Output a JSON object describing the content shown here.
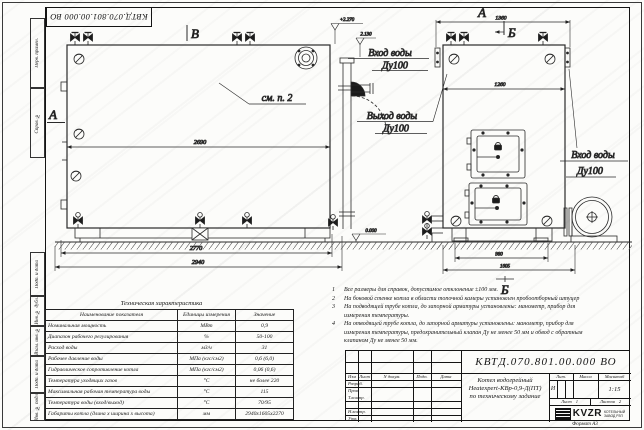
{
  "sheet": {
    "stamp_top_left": "КВТД.070.801.00.000 ВО",
    "format_label": "Формат  А3",
    "margin_labels": [
      "Перв. примен.",
      "Справ. №",
      "Подп. и дата",
      "Инв. № дубл.",
      "Взам. инв. №",
      "Подп. и дата",
      "Инв. № подл."
    ]
  },
  "views": {
    "front": {
      "view_label_top": "В",
      "view_label_side": "А",
      "see_note": "см. п. 2",
      "level_top": "+2.270",
      "level_inlet": "2.130",
      "level_ground": "0.000",
      "dim_body": "2690",
      "dim_frame": "2770",
      "dim_total": "2940",
      "inlet_title": "Вход воды",
      "inlet_dn": "Ду100",
      "outlet_title": "Выход воды",
      "outlet_dn": "Ду100"
    },
    "side": {
      "view_label": "А",
      "section_label_top": "Б",
      "section_label_bottom": "Б",
      "dim_top": "1360",
      "dim_body": "1260",
      "dim_base": "980",
      "dim_total": "1605",
      "inlet_title": "Вход воды",
      "inlet_dn": "Ду100"
    }
  },
  "notes": [
    {
      "num": "1",
      "text": "Все размеры для справок, допустимое отклонение ±100 мм."
    },
    {
      "num": "2",
      "text": "На боковой стенке котла в области топочной камеры установлен пробоотборный штуцер"
    },
    {
      "num": "3",
      "text": "На  подводящей трубе котла, до запорной арматуры установлены: манометр, прибор для измерения температуры."
    },
    {
      "num": "4",
      "text": "На отводящей трубе котла, до запорной арматуры установлены: манометр, прибор для измерения температуры, предохранительный клапан Ду не менее 50 мм и обвод с обратным клапаном Ду не менее 50 мм."
    }
  ],
  "tech_table": {
    "title": "Техническая характеристика",
    "headers": [
      "Наименование показателя",
      "Единицы измерения",
      "Значение"
    ],
    "rows": [
      {
        "name": "Номинальная мощность",
        "unit": "МВт",
        "value": "0,9"
      },
      {
        "name": "Диапазон рабочего регулирования",
        "unit": "%",
        "value": "50-100"
      },
      {
        "name": "Расход воды",
        "unit": "м3/ч",
        "value": "31"
      },
      {
        "name": "Рабочее давление воды",
        "unit": "МПа (кгс/см2)",
        "value": "0,6 (6,0)"
      },
      {
        "name": "Гидравлическое сопротивление котла",
        "unit": "МПа (кгс/см2)",
        "value": "0,06 (0,6)"
      },
      {
        "name": "Температура уходящих газов",
        "unit": "°С",
        "value": "не более 220"
      },
      {
        "name": "Максимальная рабочая температура воды",
        "unit": "°С",
        "value": "115"
      },
      {
        "name": "Температура воды (вход/выход)",
        "unit": "°С",
        "value": "70/95"
      },
      {
        "name": "Габариты котла (длина х ширина х высота)",
        "unit": "мм",
        "value": "2940х1605х2270"
      }
    ]
  },
  "title_block": {
    "doc_number": "КВТД.070.801.00.000  ВО",
    "product_line1": "Котел водогрейный",
    "product_line2": "Heatexpert-КВр-0,9-Д(ПТ)",
    "product_line3": "по техническому задание",
    "col_izm": "Изм",
    "col_list": "Лист",
    "col_ndoc": "N докум.",
    "col_podp": "Подп.",
    "col_data": "Дата",
    "row_labels": [
      "Разраб.",
      "Пров.",
      "Т.контр.",
      "",
      "Н.контр.",
      "Утв."
    ],
    "lit_header": "Лит.",
    "lit_value": "И",
    "mass_header": "Масса",
    "scale_header": "Масштаб",
    "scale_value": "1:15",
    "sheet_label": "Лист",
    "sheet_value": "1",
    "sheets_label": "Листов",
    "sheets_value": "2",
    "logo_text": "KVZR",
    "logo_sub1": "КОТЕЛЬНЫЙ",
    "logo_sub2": "ЗАВОД РЗП"
  }
}
